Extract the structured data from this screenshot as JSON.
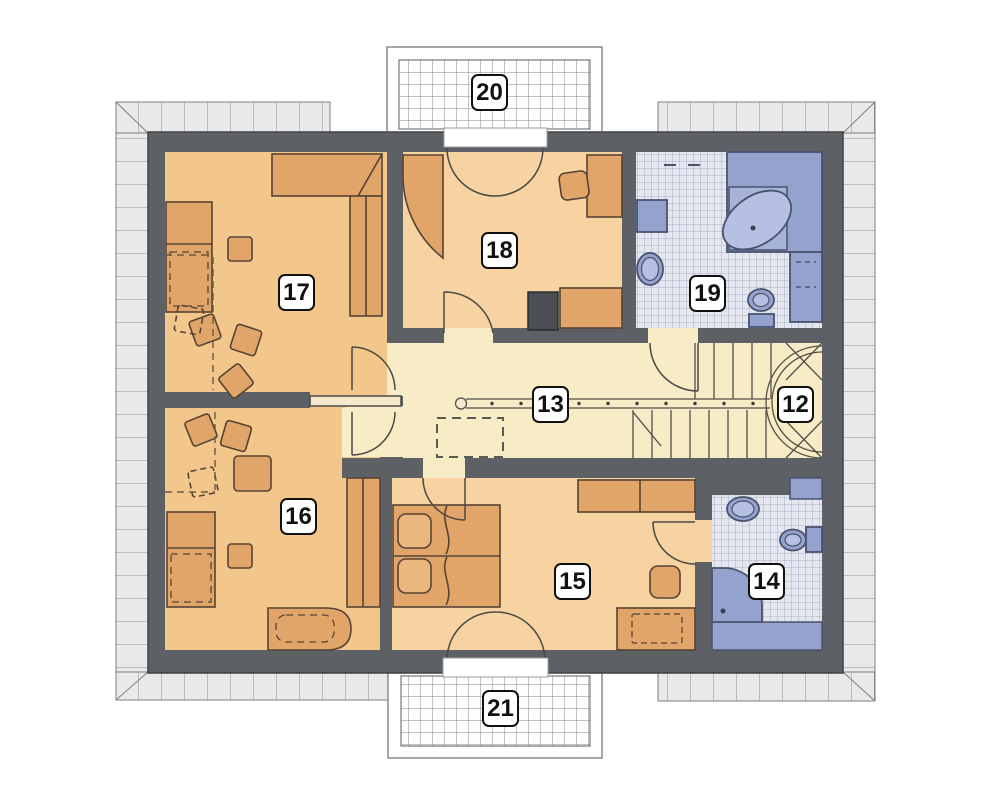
{
  "palette": {
    "wall": "#5d6165",
    "room_warm": "#f3c78b",
    "room_warm_light": "#f7d3a1",
    "hall_floor": "#f8ecc6",
    "tile_floor": "#e4e7f0",
    "tile_line": "#9aa1b8",
    "fixture_blue": "#94a2ce",
    "fixture_outline": "#49536f",
    "furniture": "#e2a569",
    "furniture_outline": "#564434",
    "eave_gray": "#e9e9e9"
  },
  "rooms": {
    "r12": {
      "number": "12"
    },
    "r13": {
      "number": "13"
    },
    "r14": {
      "number": "14"
    },
    "r15": {
      "number": "15"
    },
    "r16": {
      "number": "16"
    },
    "r17": {
      "number": "17"
    },
    "r18": {
      "number": "18"
    },
    "r19": {
      "number": "19"
    },
    "r20": {
      "number": "20"
    },
    "r21": {
      "number": "21"
    }
  }
}
